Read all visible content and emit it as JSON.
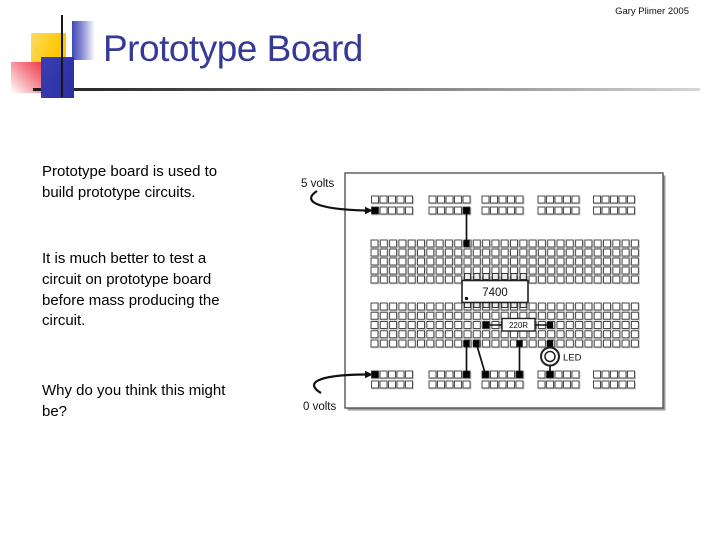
{
  "slide": {
    "author_credit": "Gary Plimer 2005",
    "title": "Prototype Board",
    "paragraphs": [
      "Prototype board is used to build prototype circuits.",
      "It is much better to test a circuit on prototype board before mass producing the circuit.",
      "Why do you think this might be?"
    ]
  },
  "diagram": {
    "labels": {
      "five_volts": "5 volts",
      "zero_volts": "0 volts",
      "chip": "7400",
      "resistor": "220R",
      "led": "LED"
    },
    "board": {
      "rail_groups": 5,
      "holes_per_group": 5,
      "rail_rows": 2,
      "main_columns": 29,
      "main_rows_per_bank": 5,
      "banks": 2
    }
  },
  "colors": {
    "title_text": "#343a96",
    "accent_yellow": "#ffc800",
    "accent_solid_blue": "#2f33ad",
    "accent_blue_gradient": "#4146b4",
    "accent_red": "#ee2233"
  }
}
